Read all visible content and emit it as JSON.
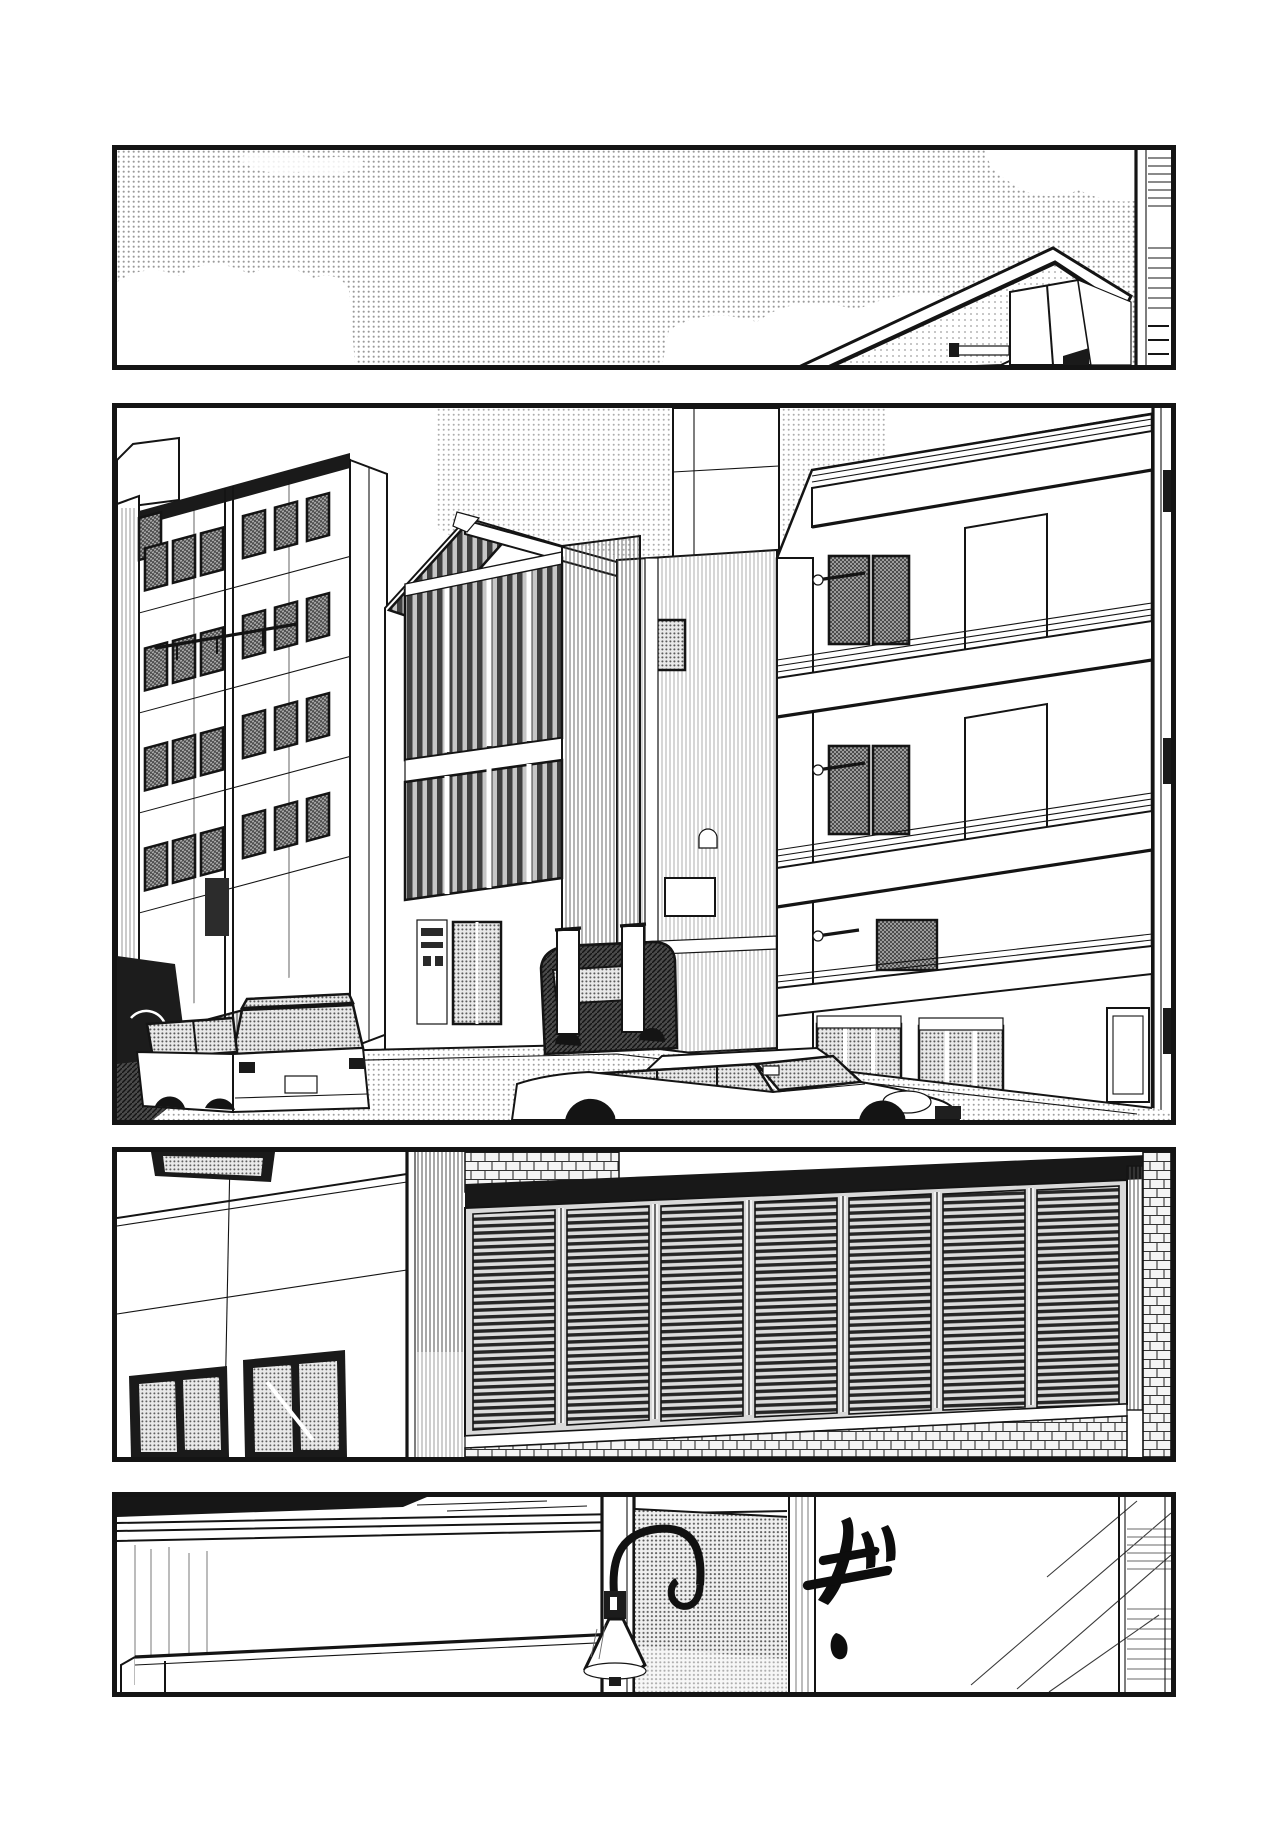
{
  "page": {
    "kind": "manga page",
    "width_px": 1284,
    "height_px": 1843,
    "panel_count": 4,
    "paper_color": "#ffffff",
    "ink_color": "#141414",
    "alt": "Black-and-white four-panel manga page: establishing shots of a city street and buildings, ending on a room interior with a creaking sound effect."
  },
  "panels": [
    {
      "id": "panel-1",
      "alt": "Wide halftone sky with white clouds; a rooftop parapet corner seen from below at lower right and a narrow building edge along the right border."
    },
    {
      "id": "panel-2",
      "alt": "Street scene: tall office building with rows of small screened windows on the left, a three-story glass-fronted building with a vending machine in the middle, a balconied apartment building on the right, and parked sedans and a dark van along the road."
    },
    {
      "id": "panel-3",
      "alt": "Low-angle close-up of a building corner: white wall with windows on the left, wide louvered shutter bays under a dark eave, and a brick base course."
    },
    {
      "id": "panel-4",
      "alt": "Interior: a gooseneck lamp with a bell shade hangs beside a dot-toned partition over a counter; on the right, a hand-drawn creak sound effect with speed lines."
    }
  ],
  "sfx": {
    "text": "ギ",
    "script": "katakana",
    "romaji": "gi",
    "meaning": "creak",
    "style": "hand-brushed strokes with dakuten marks and a comma-shaped tail"
  },
  "tones": {
    "sky_halftone": "#e4e4e4",
    "window_screen": "#8f8f8f",
    "glass_stripe_dark": "#3f3f3f",
    "louver_slat": "#262626",
    "partition_dot_tone": "#bdbdbd",
    "brick_line": "#333333"
  }
}
